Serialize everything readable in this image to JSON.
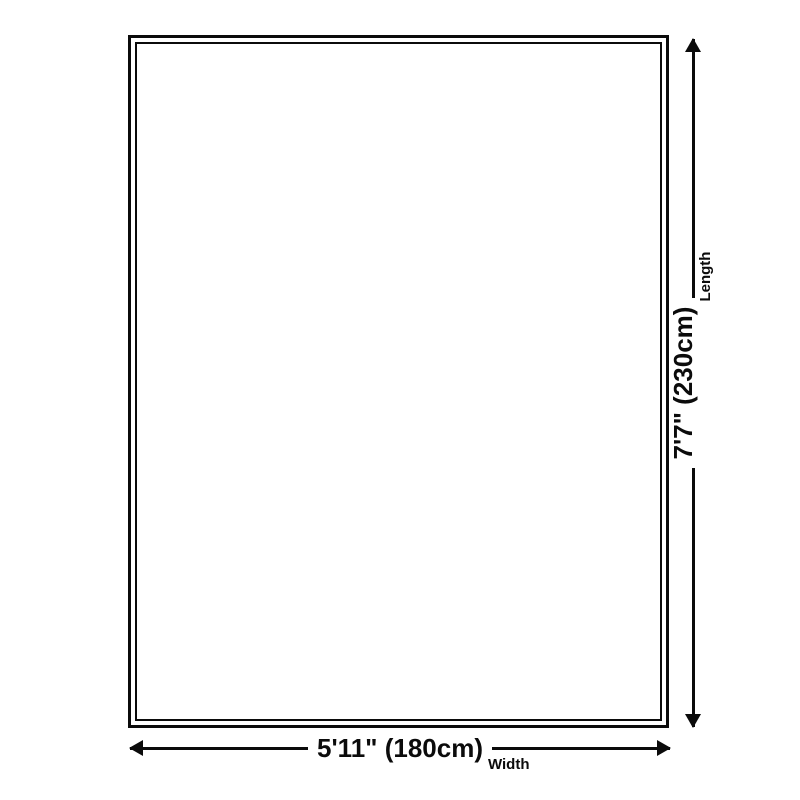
{
  "colors": {
    "background": "#ffffff",
    "stroke": "#0b0b0b"
  },
  "rug": {
    "shape": "rectangle",
    "border_style": "double-line"
  },
  "dimensions": {
    "length": {
      "value": "7'7\" (230cm)",
      "label": "Length",
      "orientation": "vertical"
    },
    "width": {
      "value": "5'11\" (180cm)",
      "label": "Width",
      "orientation": "horizontal"
    }
  },
  "icons": {
    "arrow_up": "css-triangle-up",
    "arrow_down": "css-triangle-down",
    "arrow_left": "css-triangle-left",
    "arrow_right": "css-triangle-right"
  }
}
